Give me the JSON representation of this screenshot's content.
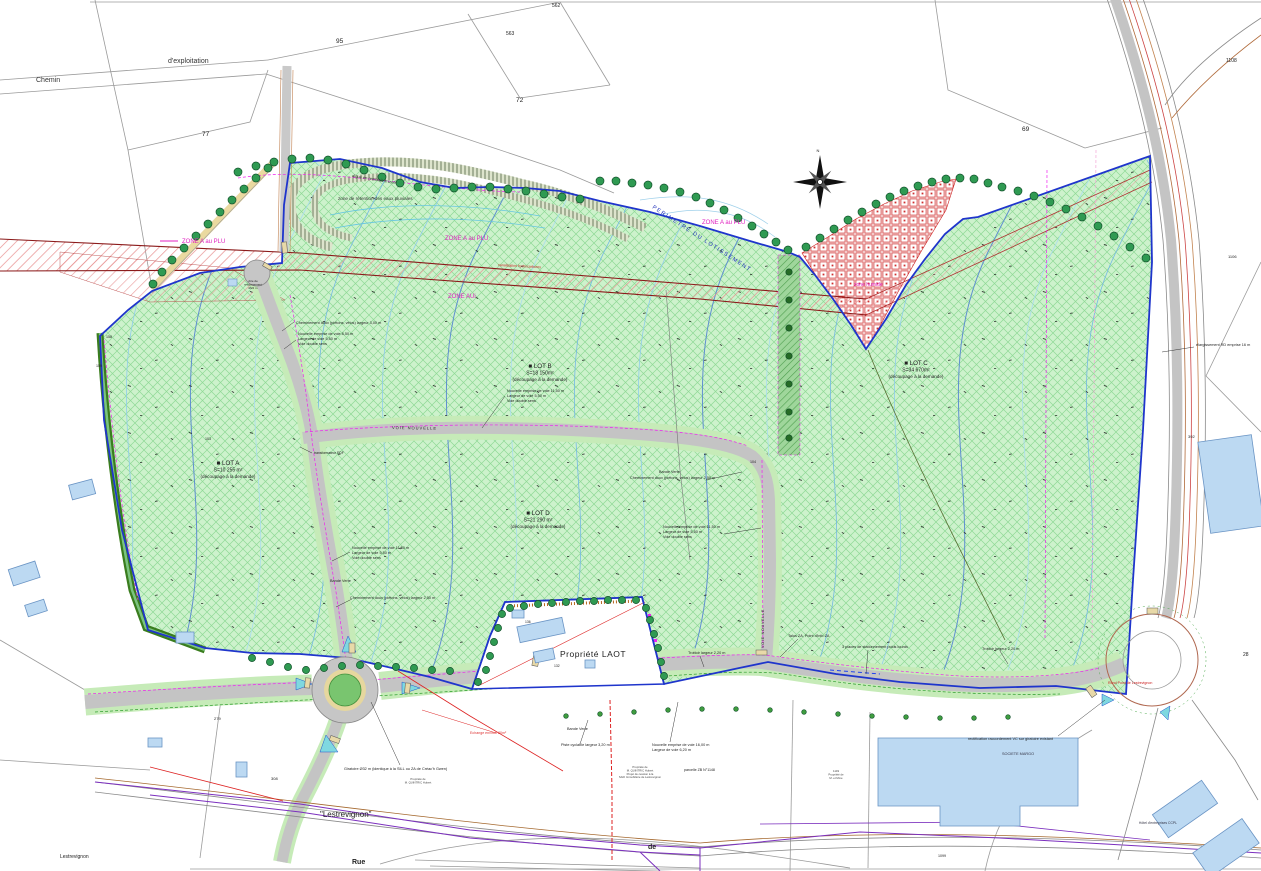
{
  "colors": {
    "site_green": "#cdf2cc",
    "green_hatch": "#8fd996",
    "perimeter_blue": "#1f35cc",
    "zone_magenta": "#e020c0",
    "corridor_red": "#8b1a1a",
    "humide_red": "#d03030",
    "road_gray": "#c4c4c4",
    "verge_green": "#c6ebB8",
    "tree_green": "#2f9a52",
    "building_blue": "#bcd9f2",
    "contour_cyan": "#8fccec",
    "hedge_green": "#3a7d1e",
    "telecom_purple": "#7b2fbe",
    "rd_brown": "#a0622d"
  },
  "labels": {
    "roads": [
      {
        "n": "road-label-chemin",
        "t": "Chemin",
        "x": 36,
        "y": 82,
        "s": 7,
        "c": "#333"
      },
      {
        "n": "road-label-dexploitation",
        "t": "d'exploitation",
        "x": 168,
        "y": 63,
        "s": 7,
        "c": "#333"
      },
      {
        "n": "road-label-voie-nouvelle-horizontal",
        "t": "VOIE NOUVELLE",
        "x": 392,
        "y": 429,
        "s": 4,
        "c": "#222",
        "r": 1,
        "sp": 1
      },
      {
        "n": "road-label-voie-nouvelle-vertical",
        "t": "VOIE NOUVELLE",
        "x": 764,
        "y": 648,
        "s": 3.6,
        "c": "#222",
        "r": -90,
        "sp": 0.8
      },
      {
        "n": "road-label-rue",
        "t": "Rue",
        "x": 352,
        "y": 864,
        "s": 7,
        "w": 700,
        "c": "#222"
      },
      {
        "n": "road-label-de",
        "t": "de",
        "x": 648,
        "y": 849,
        "s": 7,
        "w": 700,
        "c": "#222"
      },
      {
        "n": "road-label-rond-point",
        "t": "Rond Point de Lestrevignon",
        "x": 1108,
        "y": 684,
        "s": 3.6,
        "c": "#cc2222"
      }
    ],
    "zones": [
      {
        "n": "zone-a-plu-left",
        "t": "ZONE A au PLU",
        "x": 182,
        "y": 243,
        "s": 6,
        "c": "#e020c0"
      },
      {
        "n": "zone-a-plu-center",
        "t": "ZONE A au PLU",
        "x": 445,
        "y": 240,
        "s": 6,
        "c": "#e020c0"
      },
      {
        "n": "zone-a-plu-right",
        "t": "ZONE A au PLU",
        "x": 702,
        "y": 224,
        "s": 6,
        "c": "#e020c0"
      },
      {
        "n": "zone-aui",
        "t": "ZONE AUi",
        "x": 448,
        "y": 298,
        "s": 6,
        "c": "#e020c0"
      },
      {
        "n": "zone-humide",
        "t": "zone humide",
        "x": 854,
        "y": 286,
        "s": 5,
        "c": "#e020c0"
      },
      {
        "n": "perimetre-lotissement",
        "t": "PERIMETRE DU LOTISSEMENT",
        "x": 652,
        "y": 208,
        "s": 5.6,
        "c": "#2233bb",
        "r": 33,
        "sp": 1.4
      },
      {
        "n": "zone-retention",
        "t": "zone de rétention des eaux pluviales",
        "x": 338,
        "y": 200,
        "s": 4.6,
        "c": "#333"
      },
      {
        "n": "digue-remblais",
        "t": "digue en remblais à créer",
        "x": 352,
        "y": 177,
        "s": 4,
        "c": "#333",
        "r": 9
      },
      {
        "n": "corridor-servitude",
        "t": "canalisation hydrocarbures",
        "x": 498,
        "y": 266,
        "s": 3.6,
        "c": "#cc2222",
        "r": 3
      }
    ],
    "lots": [
      {
        "n": "lot-a-label",
        "lines": [
          "■ LOT A",
          "S=10 255 m²",
          "(découpage à la demande)"
        ],
        "x": 228,
        "y": 465,
        "a": "m",
        "s": 5,
        "ls": [
          6.2,
          5,
          4.6
        ],
        "lh": 6.6
      },
      {
        "n": "lot-b-label",
        "lines": [
          "■ LOT B",
          "S=18 150m²",
          "(découpage à la demande)"
        ],
        "x": 540,
        "y": 368,
        "a": "m",
        "s": 5,
        "ls": [
          6.2,
          5,
          4.6
        ],
        "lh": 6.6
      },
      {
        "n": "lot-c-label",
        "lines": [
          "■ LOT C",
          "S=34 670m²",
          "(découpage à la demande)"
        ],
        "x": 916,
        "y": 365,
        "a": "m",
        "s": 5,
        "ls": [
          6.2,
          5,
          4.6
        ],
        "lh": 6.6
      },
      {
        "n": "lot-d-label",
        "lines": [
          "■ LOT D",
          "S=21 290 m²",
          "(découpage à la demande)"
        ],
        "x": 538,
        "y": 515,
        "a": "m",
        "s": 5,
        "ls": [
          6.2,
          5,
          4.6
        ],
        "lh": 6.6
      }
    ],
    "annotations": [
      {
        "n": "ann-cheminement-doux-1",
        "t": "Cheminement doux (piétons, vélos) largeur 3,00 m",
        "x": 296,
        "y": 324,
        "s": 3.8
      },
      {
        "n": "ann-nouvelle-voie-1",
        "lines": [
          "Nouvelle emprise de voie 8,50 m",
          "Largeur de voie 5,50 m",
          "Voie double sens"
        ],
        "x": 298,
        "y": 335,
        "s": 3.8,
        "lh": 5
      },
      {
        "n": "ann-nouvelle-voie-2",
        "lines": [
          "Nouvelle emprise de voie 11,50 m",
          "Largeur de voie 5,50 m",
          "Voie double sens"
        ],
        "x": 507,
        "y": 392,
        "s": 3.8,
        "lh": 5
      },
      {
        "n": "ann-nouvelle-voie-3",
        "lines": [
          "Nouvelle emprise de voie 11,50 m",
          "Largeur de voie 5,50 m",
          "Voie double sens"
        ],
        "x": 663,
        "y": 528,
        "s": 3.8,
        "lh": 5
      },
      {
        "n": "ann-nouvelle-voie-4",
        "lines": [
          "Nouvelle emprise de voie 11,50 m",
          "Largeur de voie 5,50 m",
          "Voie double sens"
        ],
        "x": 352,
        "y": 549,
        "s": 3.8,
        "lh": 5
      },
      {
        "n": "ann-bande-verte-1",
        "t": "Bande Verte",
        "x": 659,
        "y": 473,
        "s": 3.8
      },
      {
        "n": "ann-bande-verte-2",
        "t": "Bande Verte",
        "x": 330,
        "y": 582,
        "s": 3.8
      },
      {
        "n": "ann-bande-verte-3",
        "t": "Bande Verte",
        "x": 567,
        "y": 730,
        "s": 3.8
      },
      {
        "n": "ann-cheminement-doux-2",
        "t": "Cheminement doux (piétons, vélos) largeur 2,50 m",
        "x": 630,
        "y": 479,
        "s": 3.8
      },
      {
        "n": "ann-cheminement-doux-3",
        "t": "Cheminement doux (piétons, vélos) largeur 2,50 m",
        "x": 350,
        "y": 599,
        "s": 3.8
      },
      {
        "n": "ann-trottoir-1",
        "t": "Trottoir largeur 2,20 m",
        "x": 688,
        "y": 654,
        "s": 3.8
      },
      {
        "n": "ann-trottoir-2",
        "t": "Trottoir largeur 2,20 m",
        "x": 982,
        "y": 650,
        "s": 3.8
      },
      {
        "n": "ann-talus-za",
        "t": "Talus ZA, Point d'info ZA",
        "x": 788,
        "y": 637,
        "s": 3.8
      },
      {
        "n": "ann-stationnement",
        "t": "3 places de stationnement poids lourds",
        "x": 842,
        "y": 648,
        "s": 3.8
      },
      {
        "n": "ann-piste-cyclable",
        "t": "Piste cyclable largeur 3,20 m",
        "x": 561,
        "y": 746,
        "s": 3.8
      },
      {
        "n": "ann-nouvelle-voie-5",
        "lines": [
          "Nouvelle emprise de voie 16,00 m",
          "Largeur de voie 6,20 m"
        ],
        "x": 652,
        "y": 746,
        "s": 3.8,
        "lh": 5
      },
      {
        "n": "ann-rectification",
        "t": "rectification raccordement VC sur giratoire existant",
        "x": 968,
        "y": 740,
        "s": 3.8
      },
      {
        "n": "ann-giratoire",
        "t": "Giratoire Ø32 m (identique à la SILL ou ZA de Créac'h Gwen)",
        "x": 344,
        "y": 770,
        "s": 3.8
      },
      {
        "n": "ann-elargissement-rd",
        "t": "élargissement RD emprise 16 m",
        "x": 1196,
        "y": 346,
        "s": 3.8
      },
      {
        "n": "ann-aire-retournement",
        "lines": [
          "Aire de",
          "retournement",
          "Ø22 m"
        ],
        "x": 253,
        "y": 282,
        "s": 3,
        "a": "m",
        "lh": 3.6
      },
      {
        "n": "ann-transformateur",
        "t": "transformateur EDF",
        "x": 314,
        "y": 454,
        "s": 3.4
      },
      {
        "n": "ann-echange",
        "t": "Echange environ 80m²",
        "x": 470,
        "y": 734,
        "s": 3.6,
        "c": "#dd3333"
      },
      {
        "n": "ann-parcelle-zb",
        "t": "parcelle ZB N°1148",
        "x": 684,
        "y": 771,
        "s": 3.6
      }
    ],
    "properties": [
      {
        "n": "laot-property-label",
        "t": "Propriété LAOT",
        "x": 560,
        "y": 657,
        "s": 8.5,
        "sp": 0.5,
        "c": "#222"
      },
      {
        "n": "property-block-center",
        "lines": [
          "Propriété de",
          "M. QUINTRIC Hubert",
          "Projet de cession à la",
          "SAFI Immobilière de Lestrevignon"
        ],
        "x": 640,
        "y": 768,
        "s": 2.8,
        "a": "m",
        "lh": 3.4,
        "c": "#444"
      },
      {
        "n": "property-block-west",
        "lines": [
          "Propriété de",
          "M. QUINTRIC Hubert"
        ],
        "x": 418,
        "y": 780,
        "s": 2.8,
        "a": "m",
        "lh": 3.4,
        "c": "#444"
      },
      {
        "n": "property-block-east",
        "lines": [
          "1149",
          "Propriété de",
          "M. et Mme"
        ],
        "x": 836,
        "y": 772,
        "s": 2.8,
        "a": "m",
        "lh": 3.4,
        "c": "#444"
      }
    ],
    "buildings": [
      {
        "n": "societe-margo-label",
        "t": "SOCIETE MARGO",
        "x": 1018,
        "y": 755,
        "s": 3.8,
        "a": "m",
        "c": "#334"
      },
      {
        "n": "hotel-entreprises-label",
        "t": "Hôtel d'entreprises CCPL",
        "x": 1158,
        "y": 824,
        "s": 3.4,
        "a": "m",
        "c": "#334"
      }
    ],
    "places": [
      {
        "n": "lestrevignon-quoted",
        "t": "\"Lestrevignon\"",
        "x": 320,
        "y": 817,
        "s": 8,
        "c": "#222"
      },
      {
        "n": "lestrevignon-corner",
        "t": "Lestrevignon",
        "x": 60,
        "y": 858,
        "s": 5,
        "c": "#222"
      }
    ],
    "parcels": [
      {
        "n": "parcel-95",
        "t": "95",
        "x": 336,
        "y": 43,
        "s": 6.5
      },
      {
        "n": "parcel-562",
        "t": "562",
        "x": 552,
        "y": 7,
        "s": 5
      },
      {
        "n": "parcel-563",
        "t": "563",
        "x": 506,
        "y": 35,
        "s": 5
      },
      {
        "n": "parcel-72",
        "t": "72",
        "x": 516,
        "y": 102,
        "s": 6.5
      },
      {
        "n": "parcel-77",
        "t": "77",
        "x": 202,
        "y": 136,
        "s": 6.5
      },
      {
        "n": "parcel-69",
        "t": "69",
        "x": 1022,
        "y": 131,
        "s": 6.5
      },
      {
        "n": "parcel-1108",
        "t": "1108",
        "x": 1226,
        "y": 62,
        "s": 5
      },
      {
        "n": "parcel-1106",
        "t": "1106",
        "x": 1228,
        "y": 258,
        "s": 4
      },
      {
        "n": "parcel-392",
        "t": "392",
        "x": 1188,
        "y": 438,
        "s": 4
      },
      {
        "n": "parcel-28",
        "t": "28",
        "x": 1243,
        "y": 656,
        "s": 5
      },
      {
        "n": "parcel-279",
        "t": "279",
        "x": 214,
        "y": 720,
        "s": 4
      },
      {
        "n": "parcel-308",
        "t": "308",
        "x": 271,
        "y": 780,
        "s": 4
      },
      {
        "n": "parcel-1099",
        "t": "1099",
        "x": 938,
        "y": 857,
        "s": 3.6
      },
      {
        "n": "parcel-104",
        "t": "104",
        "x": 750,
        "y": 463,
        "s": 3.6
      },
      {
        "n": "parcel-136",
        "t": "136",
        "x": 525,
        "y": 623,
        "s": 3.4
      },
      {
        "n": "parcel-132",
        "t": "132",
        "x": 554,
        "y": 667,
        "s": 3.4
      },
      {
        "n": "parcel-103",
        "t": "103",
        "x": 205,
        "y": 440,
        "s": 3.6
      },
      {
        "n": "parcel-158",
        "t": "158",
        "x": 106,
        "y": 338,
        "s": 3.6
      },
      {
        "n": "parcel-159",
        "t": "159",
        "x": 96,
        "y": 367,
        "s": 3.6
      }
    ],
    "compass": [
      {
        "n": "compass-north-label",
        "t": "N",
        "x": 818,
        "y": 152,
        "s": 4,
        "a": "m",
        "c": "#222"
      }
    ]
  }
}
